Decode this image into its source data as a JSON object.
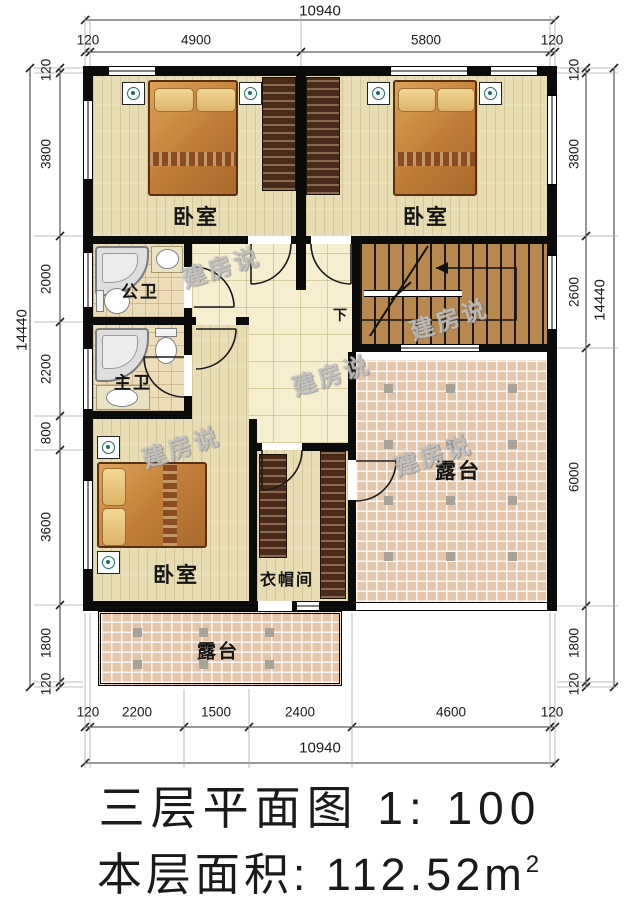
{
  "title": {
    "line1": "三层平面图 1: 100",
    "area_label": "本层面积: 112.52m",
    "area_sup": "2"
  },
  "watermark": {
    "text": "建房说"
  },
  "rooms": {
    "bedroom_top_left": "卧室",
    "bedroom_top_right": "卧室",
    "bedroom_bottom": "卧室",
    "bath_public": "公卫",
    "bath_master": "主卫",
    "cloakroom": "衣帽间",
    "terrace_right": "露台",
    "terrace_bottom": "露台",
    "stairs_down": "下"
  },
  "dimensions": {
    "top": {
      "total": "10940",
      "segments": [
        "120",
        "4900",
        "5800",
        "120"
      ]
    },
    "bottom": {
      "total": "10940",
      "segments": [
        "120",
        "2200",
        "1500",
        "2400",
        "4600",
        "120"
      ]
    },
    "left": {
      "total": "14440",
      "segments": [
        "120",
        "3800",
        "2000",
        "2200",
        "800",
        "3600",
        "1800",
        "120"
      ]
    },
    "right": {
      "total": "14440",
      "segments": [
        "120",
        "3800",
        "2600",
        "6000",
        "1800",
        "120"
      ]
    }
  },
  "colors": {
    "wall": "#0b0b0b",
    "wood_floor": "#e7dcb2",
    "hall_tile": "#f6efcf",
    "bath_tile": "#ecdcb8",
    "terrace_tile": "#e4c5a9",
    "terrace_accent": "#a9a296",
    "stairs": "#b8894f"
  }
}
